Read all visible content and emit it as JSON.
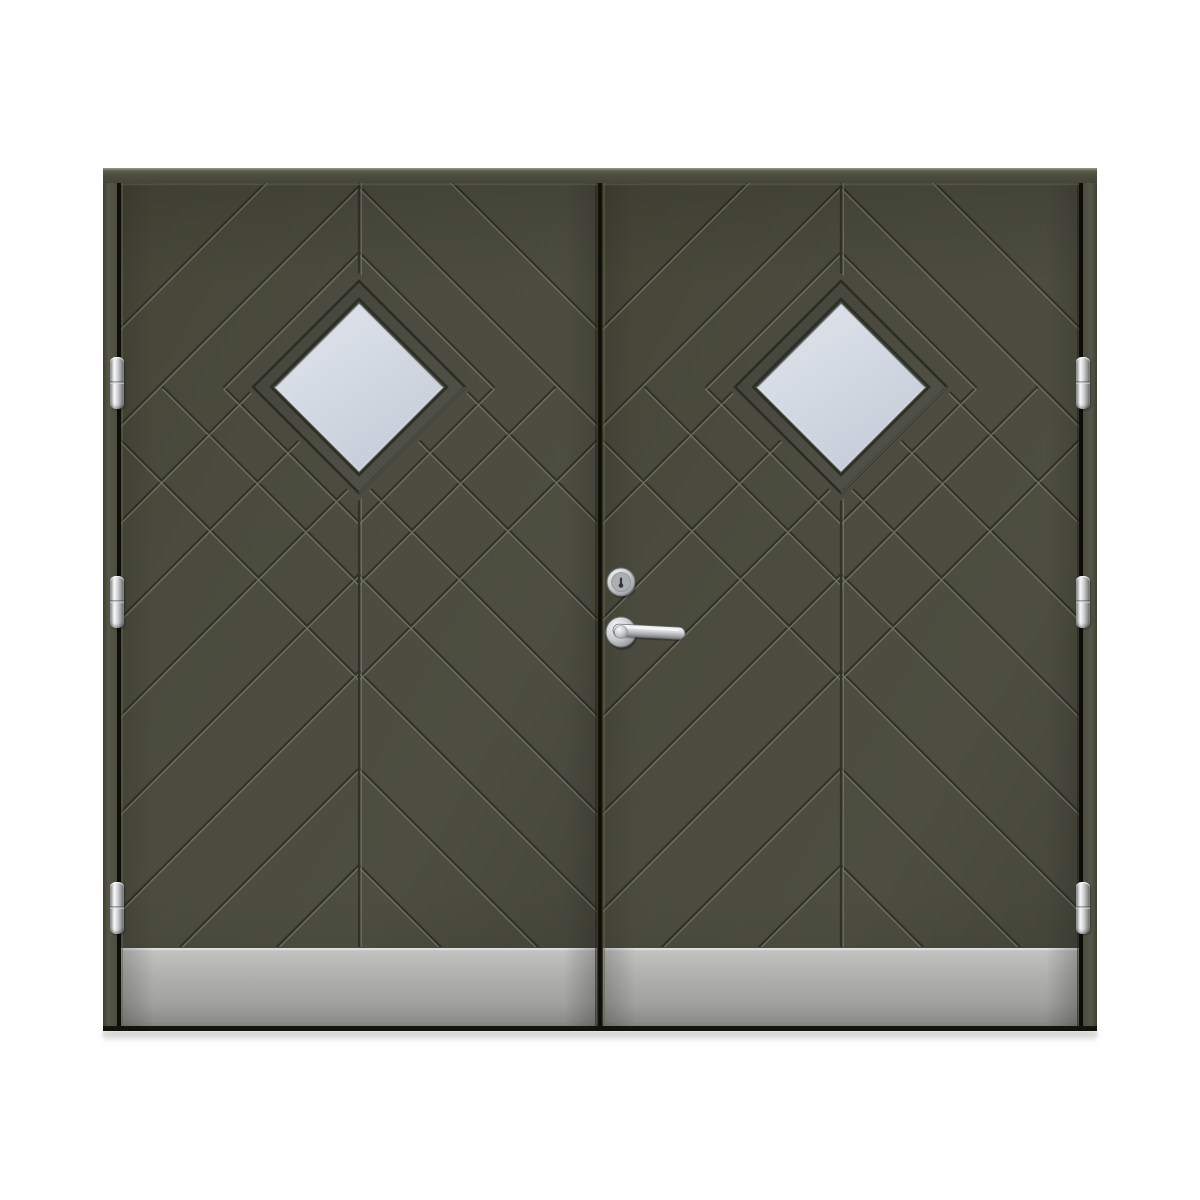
{
  "scene": {
    "label": "dark-olive-double-front-door-product-photo",
    "background": "#ffffff"
  },
  "colors": {
    "leaf_base": "#4a4b3e",
    "leaf_dark": "#434435",
    "leaf_light": "#4d4e41",
    "groove_dark": "#30312a",
    "groove_light": "#767863",
    "frame_face": "#4b4c3e",
    "frame_top_highlight": "#9a9c86",
    "separator_dark": "#0f0f0a",
    "edge_bevel": "#62644f",
    "gap_dark": "#0d0d08",
    "window_outline": "#2a2b23",
    "window_frame_light": "#53544a",
    "window_frame_dark": "#41423a",
    "glass_light": "#e2e6ec",
    "glass_mid": "#d5dbe4",
    "glass_dark": "#c6cdd8",
    "kick_highlight": "#e2e2e0",
    "kick_top": "#cbcbc9",
    "kick_mid": "#b0b0ae",
    "kick_bottom": "#8e8e8c",
    "chrome_light": "#f5f6f6",
    "chrome_mid": "#c6c9cb",
    "chrome_dark": "#84888b",
    "chrome_edge": "#6b6e71",
    "keyhole": "#33373a",
    "shadow": "rgba(0,0,0,0.24)"
  },
  "frame": {
    "x": 103,
    "y": 168,
    "width": 994,
    "head_h": 15,
    "jamb_w": 14,
    "jamb_bottom": 1030
  },
  "leaves": {
    "top": 183,
    "bottom": 1027,
    "left": {
      "x": 121,
      "w": 476
    },
    "right": {
      "x": 603,
      "w": 476
    },
    "gap_x": 597,
    "gap_w": 6,
    "side_gap_left_x": 117,
    "side_gap_right_x": 1079,
    "side_gap_w": 4
  },
  "pattern": {
    "apex_ys": [
      89,
      186,
      283,
      380,
      477,
      574,
      671,
      768,
      865
    ],
    "window_cy": 387,
    "window_outer_r": 106,
    "window_glass_r": 84,
    "window_clip_r": 114,
    "ring_full_r": 135,
    "ring_lower_rs": [
      196,
      291
    ],
    "groove_angle_deg": 45
  },
  "kickplate": {
    "y": 948
  },
  "hinges": {
    "w": 14,
    "h": 52,
    "tops": [
      357,
      576,
      882
    ],
    "left_x": 110,
    "right_x": 1076,
    "icon": "hinge-icon"
  },
  "hardware": {
    "cylinder": {
      "cx": 621,
      "cy": 582,
      "r": 14,
      "icon": "lock-cylinder-icon"
    },
    "rose": {
      "cx": 621,
      "cy": 632,
      "r": 15
    },
    "lever": {
      "x": 613,
      "y": 624,
      "len": 72,
      "th": 12,
      "tilt_deg": 3,
      "icon": "door-handle-icon"
    },
    "bottom_line_y": 1026,
    "bottom_line_h": 5
  }
}
